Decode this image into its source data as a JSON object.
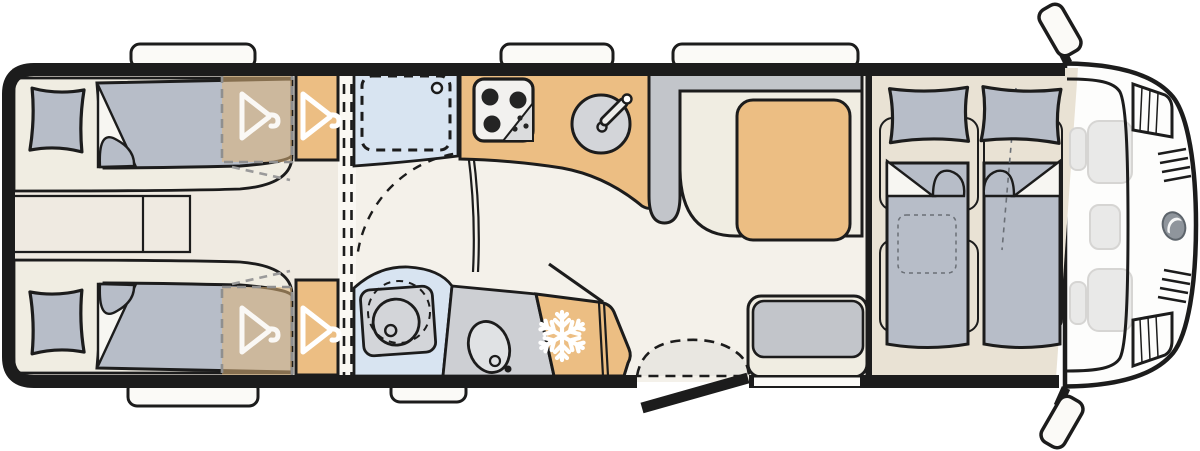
{
  "title": "Motorhome floor plan (top view)",
  "diagram_type": "vehicle-floorplan",
  "palette": {
    "line": "#1c1c1c",
    "wall": "#1c1c1c",
    "floor_main": "#F4F1EA",
    "floor_bedroom": "#EFEAE1",
    "floor_corridor": "#FAF8F3",
    "floor_cab": "#E9E2D4",
    "upholstery": "#B7BDC8",
    "bench_gray": "#C2C5CA",
    "cushion_cream": "#F0EDE2",
    "accent_wood": "#ECBE83",
    "wardrobe_ghost": "rgba(223,181,122,0.55)",
    "wet_blue": "#D8E4F1",
    "appliance_gray": "#D3D5D9",
    "counter_gray": "#CDCFD3",
    "stove_white": "#F2F1EF",
    "window_white": "#FBFAF7",
    "cab_white": "#FDFDFC",
    "ghost_gray": "#E9E9E8",
    "ghost_stroke": "#D6D5D3",
    "hint_gray": "#9a9a9a",
    "logo_gray": "#8F959C",
    "icon_white": "#FFFFFF"
  },
  "rooms": [
    {
      "name": "rear-bedroom",
      "features": [
        "single-bed-top",
        "single-bed-bottom",
        "pillows",
        "bedside-step",
        "wardrobe-ghost",
        "wardrobe"
      ]
    },
    {
      "name": "washroom",
      "features": [
        "shower-tray",
        "swivel-toilet",
        "washbasin"
      ]
    },
    {
      "name": "kitchen",
      "features": [
        "hob-3-burner",
        "round-sink",
        "fridge-freezer"
      ]
    },
    {
      "name": "lounge",
      "features": [
        "l-shaped-dinette",
        "table",
        "travel-bench",
        "entry-door"
      ]
    },
    {
      "name": "cab",
      "features": [
        "drop-down-bed",
        "cab-seats-ghost",
        "windshield",
        "headlights",
        "grille",
        "mirrors",
        "logo"
      ]
    }
  ],
  "icons": {
    "hanger": "hanger-icon",
    "snowflake": "snowflake-icon",
    "burner": "burner-icon",
    "drain": "drain-icon"
  },
  "counts": {
    "windows_top": 3,
    "windows_bottom": 2,
    "beds_rear": 2,
    "beds_cab": 2,
    "hangers": 4
  }
}
